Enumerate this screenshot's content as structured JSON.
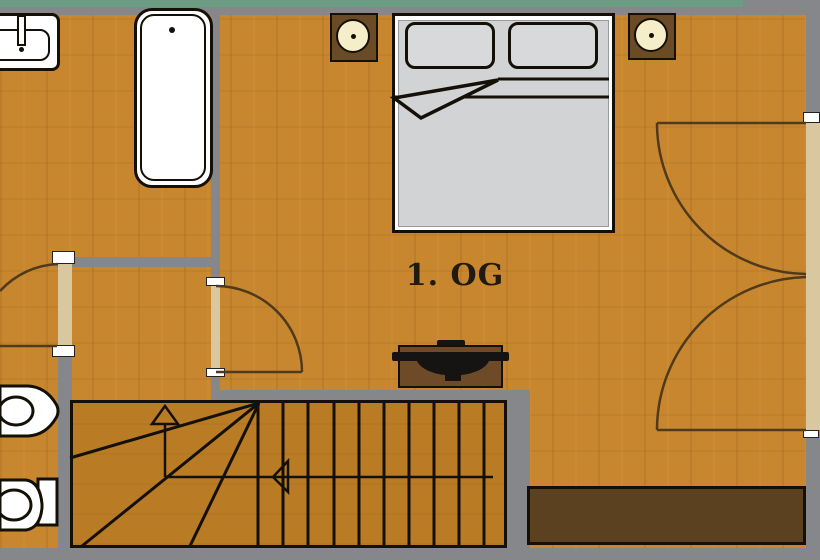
{
  "floor_label": "1. OG",
  "colors": {
    "floor": "#c8872e",
    "stairs": "#b97c24",
    "wall": "#85878a",
    "outside": "#6b9c84",
    "opening": "#d9c7a0",
    "fixture": "#ffffff",
    "bedframe": "#ffffff",
    "mattress": "#d2d3d4",
    "pillow": "#d8d9da",
    "nightstand": "#6b4a26",
    "lamp": "#f6eec9",
    "stove": "#6e4a28",
    "stovedark": "#161412",
    "wardrobe": "#5c4120",
    "outline": "#141007",
    "doorline": "#4f3a1c",
    "label": "#201a10"
  },
  "elements": {
    "rooms": [
      "bathroom",
      "wc",
      "hallway",
      "bedroom",
      "stairwell"
    ],
    "furniture_icons": [
      "sink-icon",
      "bathtub-icon",
      "bidet-icon",
      "toilet-icon",
      "double-bed-icon",
      "pillow-icon",
      "nightstand-icon",
      "bedside-lamp-icon",
      "stove-icon",
      "wardrobe-icon",
      "stairs-icon"
    ],
    "doors": [
      "wc-door",
      "bedroom-door",
      "french-double-door"
    ],
    "stair_treads_straight": 11,
    "stair_direction": "up-arrow"
  }
}
